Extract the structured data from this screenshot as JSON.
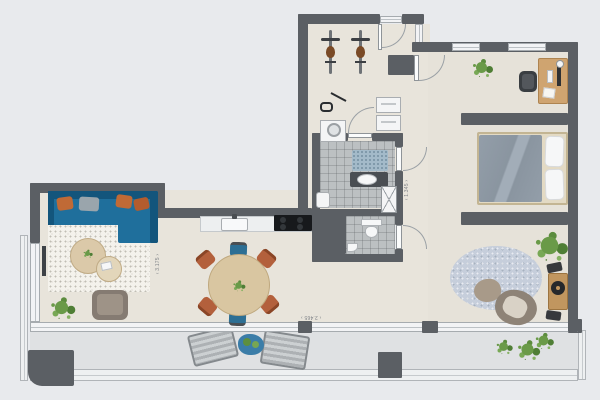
{
  "plan_title": "apartment-floor-plan",
  "palette": {
    "background": "#e8eaed",
    "wall": "#5b5f64",
    "floor": "#e8e4db",
    "bathroom_tile": "#bcc0c2",
    "balcony_floor": "#dfe1e3",
    "window_frame": "#f2f3f5",
    "sofa_blue": "#1f6f9c",
    "accent_rust": "#b3603c",
    "wood_light": "#d9c6a1",
    "plant_green": "#6a9a48",
    "bed_duvet": "#8f9aa5"
  },
  "dimension_labels": {
    "living_vertical": "‹ 3.175 ›",
    "corridor_vertical": "‹ 1.345 ›",
    "terrace_horizontal": "‹ 2.465 ›"
  },
  "rooms": [
    {
      "name": "entrance-hall",
      "furniture": [
        "bicycle",
        "bicycle",
        "vacuum-cleaner",
        "washing-machine",
        "utility-closets"
      ]
    },
    {
      "name": "bathroom",
      "furniture": [
        "bath-mat",
        "washbasin-counter",
        "shower",
        "cabinet"
      ]
    },
    {
      "name": "wc",
      "furniture": [
        "toilet",
        "corner-basin"
      ]
    },
    {
      "name": "living-room",
      "furniture": [
        "corner-sofa",
        "cushions",
        "rug",
        "coffee-tables",
        "armchair",
        "plant",
        "dining-table",
        "six-chairs",
        "kitchen-counter",
        "sink",
        "cooktop"
      ]
    },
    {
      "name": "bedroom",
      "furniture": [
        "desk",
        "monitor",
        "office-chair",
        "plant",
        "double-bed",
        "pillows",
        "round-rug",
        "lounge-chair",
        "pouf",
        "record-player",
        "speakers",
        "large-plant"
      ]
    },
    {
      "name": "balcony",
      "furniture": [
        "sun-lounger",
        "sun-lounger",
        "side-table",
        "plants"
      ]
    }
  ]
}
